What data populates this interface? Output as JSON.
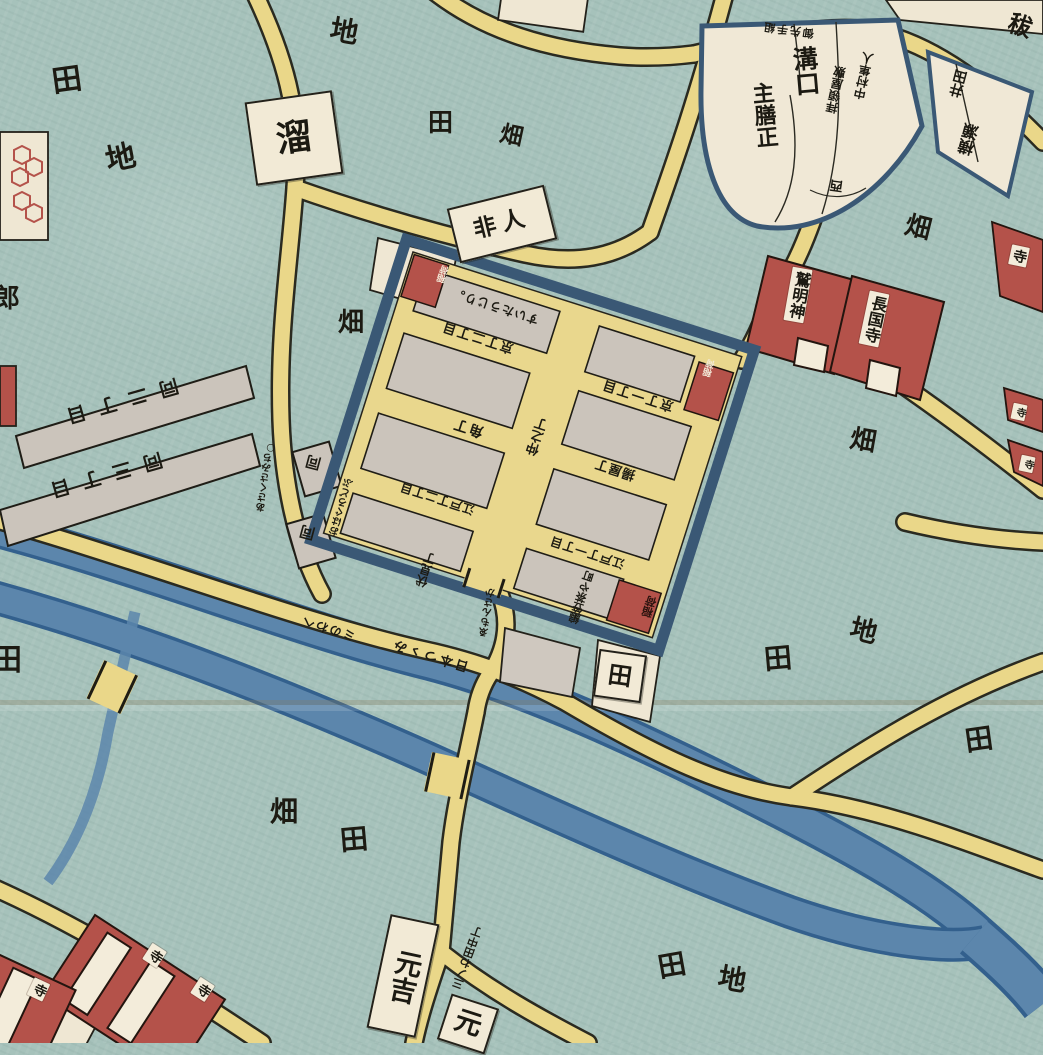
{
  "map_kind": "edo-period-woodblock-district-map",
  "palette": {
    "field_teal": "#a6c2bb",
    "road_yellow": "#ead789",
    "road_casing": "#2a2a20",
    "canal_blue": "#5c86ac",
    "canal_edge": "#33608d",
    "wall_blue": "#3a5875",
    "block_gray": "#cbc4bb",
    "block_white": "#f2ead6",
    "temple_red": "#b4524a",
    "ink": "#1c1a12",
    "crease": "rgba(140,125,95,0.30)"
  },
  "labels": [
    {
      "n": "field-label-ta-1",
      "k": "plain",
      "t": "田",
      "x": 52,
      "y": 66,
      "r": -8,
      "fs": 30
    },
    {
      "n": "field-label-chi-1",
      "k": "plain",
      "t": "地",
      "x": 106,
      "y": 144,
      "r": -12,
      "fs": 30
    },
    {
      "n": "field-label-chi-2",
      "k": "plain",
      "t": "地",
      "x": 330,
      "y": 18,
      "r": 10,
      "fs": 28
    },
    {
      "n": "field-label-ta-2",
      "k": "plain",
      "t": "田",
      "x": 428,
      "y": 110,
      "r": 0,
      "fs": 25
    },
    {
      "n": "field-label-hata-1",
      "k": "plain",
      "t": "畑",
      "x": 500,
      "y": 124,
      "r": 12,
      "fs": 23
    },
    {
      "n": "field-label-hata-2",
      "k": "plain",
      "t": "畑",
      "x": 338,
      "y": 310,
      "r": 0,
      "fs": 26
    },
    {
      "n": "field-label-hata-3",
      "k": "plain",
      "t": "畑",
      "x": 905,
      "y": 215,
      "r": 14,
      "fs": 26
    },
    {
      "n": "field-label-hata-4",
      "k": "plain",
      "t": "畑",
      "x": 850,
      "y": 428,
      "r": 10,
      "fs": 26
    },
    {
      "n": "field-label-chi-3",
      "k": "plain",
      "t": "地",
      "x": 850,
      "y": 618,
      "r": 14,
      "fs": 27
    },
    {
      "n": "field-label-ta-3",
      "k": "plain",
      "t": "田",
      "x": 764,
      "y": 645,
      "r": -5,
      "fs": 28
    },
    {
      "n": "field-label-ta-4",
      "k": "plain",
      "t": "田",
      "x": 965,
      "y": 726,
      "r": -8,
      "fs": 28
    },
    {
      "n": "field-label-ta-5",
      "k": "plain",
      "t": "田",
      "x": -8,
      "y": 646,
      "r": 0,
      "fs": 30
    },
    {
      "n": "field-label-hata-5",
      "k": "plain",
      "t": "畑",
      "x": 270,
      "y": 798,
      "r": 0,
      "fs": 28
    },
    {
      "n": "field-label-ta-6",
      "k": "plain",
      "t": "田",
      "x": 340,
      "y": 826,
      "r": -5,
      "fs": 28
    },
    {
      "n": "field-label-ta-7",
      "k": "plain",
      "t": "田",
      "x": 658,
      "y": 952,
      "r": -10,
      "fs": 28
    },
    {
      "n": "field-label-chi-4",
      "k": "plain",
      "t": "地",
      "x": 718,
      "y": 966,
      "r": 10,
      "fs": 28
    },
    {
      "n": "edge-label-ro",
      "k": "plain",
      "t": "郎",
      "x": -6,
      "y": 286,
      "r": 0,
      "fs": 26
    },
    {
      "n": "edge-label-hatsu",
      "k": "plain",
      "t": "秡",
      "x": 1008,
      "y": 14,
      "r": 18,
      "fs": 24
    },
    {
      "n": "tame-box",
      "k": "box",
      "t": "溜",
      "x": 250,
      "y": 96,
      "r": -8,
      "fs": 36,
      "w": 84,
      "h": 80
    },
    {
      "n": "hinin-box",
      "k": "box",
      "t": "非人",
      "x": 452,
      "y": 196,
      "r": -14,
      "fs": 23,
      "w": 96,
      "h": 52,
      "ls": 6
    },
    {
      "n": "ta-box",
      "k": "box",
      "t": "田",
      "x": 596,
      "y": 652,
      "r": 8,
      "fs": 24,
      "w": 44,
      "h": 44
    },
    {
      "n": "motoyoshi-box",
      "k": "box",
      "t": "元吉",
      "x": 378,
      "y": 918,
      "r": 12,
      "fs": 27,
      "w": 46,
      "h": 112,
      "v": true
    },
    {
      "n": "moto-box",
      "k": "box",
      "t": "元",
      "x": 443,
      "y": 1000,
      "r": 18,
      "fs": 27,
      "w": 46,
      "h": 44
    },
    {
      "n": "estate-mizoguchi-1",
      "k": "plain",
      "t": "溝口",
      "x": 792,
      "y": 46,
      "r": -5,
      "fs": 25,
      "v": true
    },
    {
      "n": "estate-mizoguchi-2",
      "k": "plain",
      "t": "主膳正",
      "x": 752,
      "y": 82,
      "r": -5,
      "fs": 22,
      "v": true
    },
    {
      "n": "estate-nishi",
      "k": "plain",
      "t": "西",
      "x": 830,
      "y": 178,
      "r": 188,
      "fs": 13
    },
    {
      "n": "estate-strip",
      "k": "plain",
      "t": "御先手組",
      "x": 762,
      "y": 24,
      "r": 188,
      "fs": 11,
      "ls": 2
    },
    {
      "n": "estate-nakamura",
      "k": "plain",
      "t": "中村隼人",
      "x": 858,
      "y": 52,
      "r": 192,
      "fs": 12,
      "v": true
    },
    {
      "n": "estate-hairyo",
      "k": "plain",
      "t": "拝領屋敷",
      "x": 830,
      "y": 66,
      "r": 192,
      "fs": 12,
      "v": true
    },
    {
      "n": "estate-ida",
      "k": "plain",
      "t": "井田",
      "x": 952,
      "y": 70,
      "r": 195,
      "fs": 14,
      "v": true
    },
    {
      "n": "estate-yokose",
      "k": "plain",
      "t": "横瀬",
      "x": 962,
      "y": 124,
      "r": 195,
      "fs": 16,
      "v": true
    },
    {
      "n": "shrine-washi-myojin",
      "k": "strip",
      "t": "鷲明神",
      "x": 788,
      "y": 268,
      "r": 10,
      "fs": 16,
      "v": true
    },
    {
      "n": "temple-chokokuji",
      "k": "strip",
      "t": "長国寺",
      "x": 864,
      "y": 292,
      "r": 12,
      "fs": 16,
      "v": true
    },
    {
      "n": "temple-edge-a",
      "k": "strip",
      "t": "寺",
      "x": 1010,
      "y": 246,
      "r": 12,
      "fs": 14,
      "v": true
    },
    {
      "n": "temple-edge-b",
      "k": "strip",
      "t": "寺",
      "x": 1012,
      "y": 404,
      "r": 12,
      "fs": 10,
      "v": true
    },
    {
      "n": "temple-edge-c",
      "k": "strip",
      "t": "寺",
      "x": 1020,
      "y": 456,
      "r": 12,
      "fs": 10,
      "v": true
    },
    {
      "n": "temple-sw-1",
      "k": "strip",
      "t": "寺",
      "x": 146,
      "y": 946,
      "r": 33,
      "fs": 13,
      "v": true
    },
    {
      "n": "temple-sw-2",
      "k": "strip",
      "t": "寺",
      "x": 194,
      "y": 980,
      "r": 33,
      "fs": 13,
      "v": true
    },
    {
      "n": "temple-sw-3",
      "k": "strip",
      "t": "寺",
      "x": 30,
      "y": 980,
      "r": 25,
      "fs": 13,
      "v": true
    },
    {
      "n": "yoshiwara-suidojiri",
      "k": "plain",
      "t": "すいたうじり。",
      "x": 450,
      "y": 300,
      "r": 198,
      "fs": 12,
      "ls": 1
    },
    {
      "n": "yoshiwara-kyomachi-2",
      "k": "plain",
      "t": "京丁二丁目",
      "x": 440,
      "y": 330,
      "r": 198,
      "fs": 13,
      "ls": 2
    },
    {
      "n": "yoshiwara-kyomachi-1",
      "k": "plain",
      "t": "京丁一丁目",
      "x": 600,
      "y": 388,
      "r": 198,
      "fs": 13,
      "ls": 2
    },
    {
      "n": "yoshiwara-sumicho",
      "k": "plain",
      "t": "角丁",
      "x": 452,
      "y": 420,
      "r": 198,
      "fs": 14,
      "ls": 2
    },
    {
      "n": "yoshiwara-ageyacho",
      "k": "plain",
      "t": "揚屋丁",
      "x": 594,
      "y": 462,
      "r": 198,
      "fs": 13,
      "ls": 1
    },
    {
      "n": "yoshiwara-nakanocho",
      "k": "plain",
      "t": "仲之丁",
      "x": 532,
      "y": 418,
      "r": 198,
      "fs": 13,
      "v": true
    },
    {
      "n": "yoshiwara-edocho-2",
      "k": "plain",
      "t": "江戸丁二丁目",
      "x": 398,
      "y": 492,
      "r": 198,
      "fs": 12,
      "ls": 1
    },
    {
      "n": "yoshiwara-edocho-1",
      "k": "plain",
      "t": "江戸丁一丁目",
      "x": 548,
      "y": 546,
      "r": 198,
      "fs": 12,
      "ls": 1
    },
    {
      "n": "yoshiwara-fushimicho",
      "k": "plain",
      "t": "伏見丁",
      "x": 420,
      "y": 552,
      "r": 198,
      "fs": 12,
      "v": true
    },
    {
      "n": "yoshiwara-amigasa",
      "k": "plain",
      "t": "編笠茶や町",
      "x": 576,
      "y": 570,
      "r": 198,
      "fs": 11,
      "v": true
    },
    {
      "n": "yoshiwara-inari-se",
      "k": "plain",
      "t": "稲荷",
      "x": 644,
      "y": 596,
      "r": 198,
      "fs": 11,
      "v": true,
      "c": "#2a130e"
    },
    {
      "n": "yoshiwara-inari-nw",
      "k": "plain",
      "t": "稲荷",
      "x": 440,
      "y": 266,
      "r": 198,
      "fs": 9,
      "v": true,
      "c": "#f3ead8"
    },
    {
      "n": "yoshiwara-inari-ne",
      "k": "plain",
      "t": "稲荷",
      "x": 706,
      "y": 360,
      "r": 198,
      "fs": 9,
      "v": true,
      "c": "#f3ead8"
    },
    {
      "n": "moat-note-ohaguro",
      "k": "plain",
      "t": "おはぐろどぶ",
      "x": 338,
      "y": 478,
      "r": 196,
      "fs": 10,
      "v": true
    },
    {
      "n": "emonzaka-note",
      "k": "plain",
      "t": "ゑもんさか",
      "x": 484,
      "y": 588,
      "r": 190,
      "fs": 10,
      "v": true
    },
    {
      "n": "road-nihon-tsutsumi",
      "k": "plain",
      "t": "日本つゝみ",
      "x": 390,
      "y": 648,
      "r": 197,
      "fs": 13,
      "ls": 3
    },
    {
      "n": "road-minowa-note",
      "k": "plain",
      "t": "ミのわへ",
      "x": 300,
      "y": 622,
      "r": 197,
      "fs": 12,
      "ls": 2
    },
    {
      "n": "road-minowa-tanaka",
      "k": "plain",
      "t": "三ノわ田中丁",
      "x": 462,
      "y": 925,
      "r": 200,
      "fs": 11,
      "v": true
    },
    {
      "n": "road-asakusa-note",
      "k": "plain",
      "t": "あさくさみち○",
      "x": 262,
      "y": 442,
      "r": 188,
      "fs": 10,
      "v": true
    },
    {
      "n": "ditto-box-1",
      "k": "plain",
      "t": "同",
      "x": 306,
      "y": 454,
      "r": 195,
      "fs": 15
    },
    {
      "n": "ditto-box-2",
      "k": "plain",
      "t": "同",
      "x": 300,
      "y": 524,
      "r": 195,
      "fs": 15
    },
    {
      "n": "tamachi-2chome",
      "k": "plain",
      "t": "同二丁目",
      "x": 52,
      "y": 392,
      "r": 164,
      "fs": 19,
      "ls": 13
    },
    {
      "n": "tamachi-3chome",
      "k": "plain",
      "t": "同三丁目",
      "x": 36,
      "y": 466,
      "r": 164,
      "fs": 19,
      "ls": 13
    }
  ]
}
